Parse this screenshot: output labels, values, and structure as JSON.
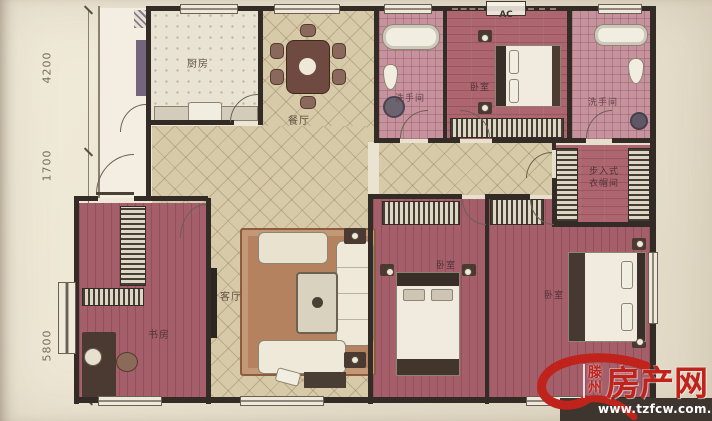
{
  "plan": {
    "dimensions": {
      "top": "4200",
      "middle": "1700",
      "bottom": "5800"
    },
    "ac_label": "AC",
    "rooms": {
      "kitchen": "厨房",
      "dining": "餐厅",
      "bath_top": "洗手间",
      "bedroom_top": "卧室",
      "bath_right": "洗手间",
      "closet": "步入式衣帽间",
      "living": "客厅",
      "study": "书房",
      "bedroom_mid": "卧室",
      "bedroom_right": "卧室",
      "bay_window": "飘窗"
    }
  },
  "watermark": {
    "city": "滕州",
    "brand": "房产网",
    "url": "www.tzfcw.com.cn",
    "red": "#c0231c"
  },
  "colors": {
    "paper": "#ebe4d2",
    "wall": "#332b26",
    "tile_floor": "#d7caa8",
    "wood_floor": "#ad6570",
    "bath_floor": "#c6929d",
    "watermark_red": "#c0231c"
  }
}
